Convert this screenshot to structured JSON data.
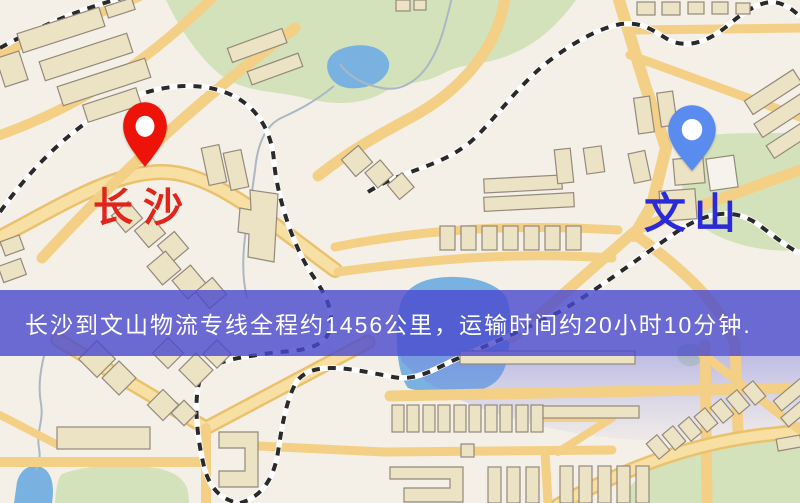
{
  "banner": {
    "text": "长沙到文山物流专线全程约1456公里，运输时间约20小时10分钟.",
    "background_color": "rgba(72,72,206,0.8)",
    "text_color": "#ffffff"
  },
  "markers": {
    "origin": {
      "label": "长沙",
      "pin_color": "#ee1309",
      "label_color": "#e0251c"
    },
    "destination": {
      "label": "文山",
      "pin_color": "#5a8bef",
      "label_color": "#2a2ad8"
    }
  },
  "map_colors": {
    "background": "#f4efe7",
    "road_fill": "#f3d086",
    "road_casing": "#eac26e",
    "building_fill": "#ece2c4",
    "building_stroke": "#94897b",
    "park": "#d3e2ba",
    "water": "#79b2e0",
    "railway_dark": "#2a2a2a",
    "tint": "#8c90e0"
  }
}
